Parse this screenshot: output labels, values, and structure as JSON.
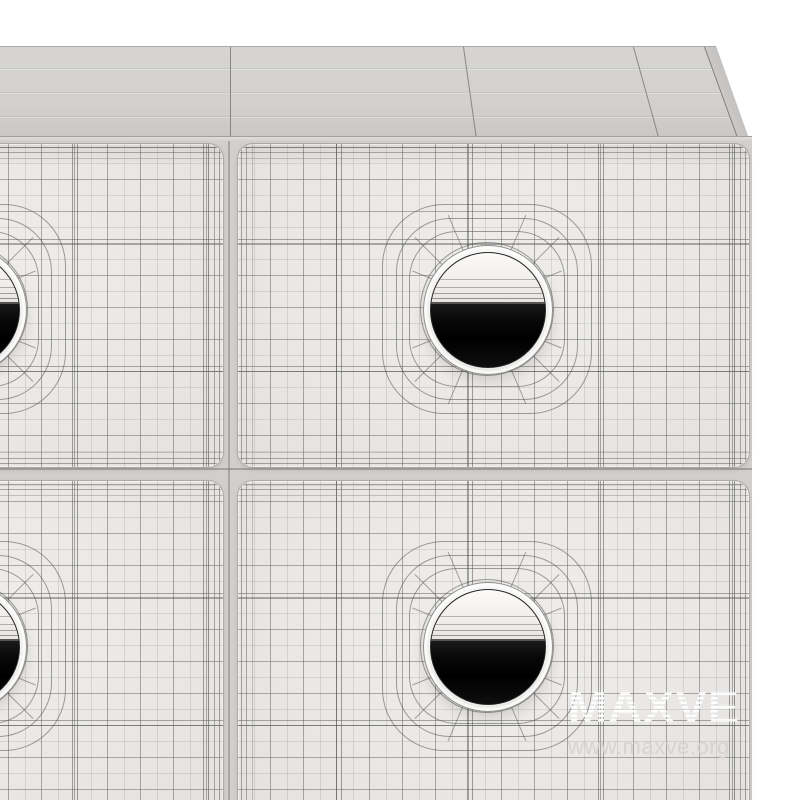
{
  "scene": {
    "object": "3D wireframe render of a chest of drawers",
    "drawer_rows_visible": 2,
    "drawer_columns_visible": 2,
    "handle_type": "circular cutout with dark interior"
  },
  "watermark": {
    "brand": "MAXVE",
    "website": "www.maxve.org"
  },
  "colors": {
    "background": "#ffffff",
    "top_surface": "#d2d1ce",
    "drawer_face": "#eae8e6",
    "carcass": "#d1cfcc",
    "wire_line": "#6e6c6a",
    "hole_interior": "#060606",
    "watermark_white": "#ffffff",
    "url_gray": "#d5d2ce"
  }
}
